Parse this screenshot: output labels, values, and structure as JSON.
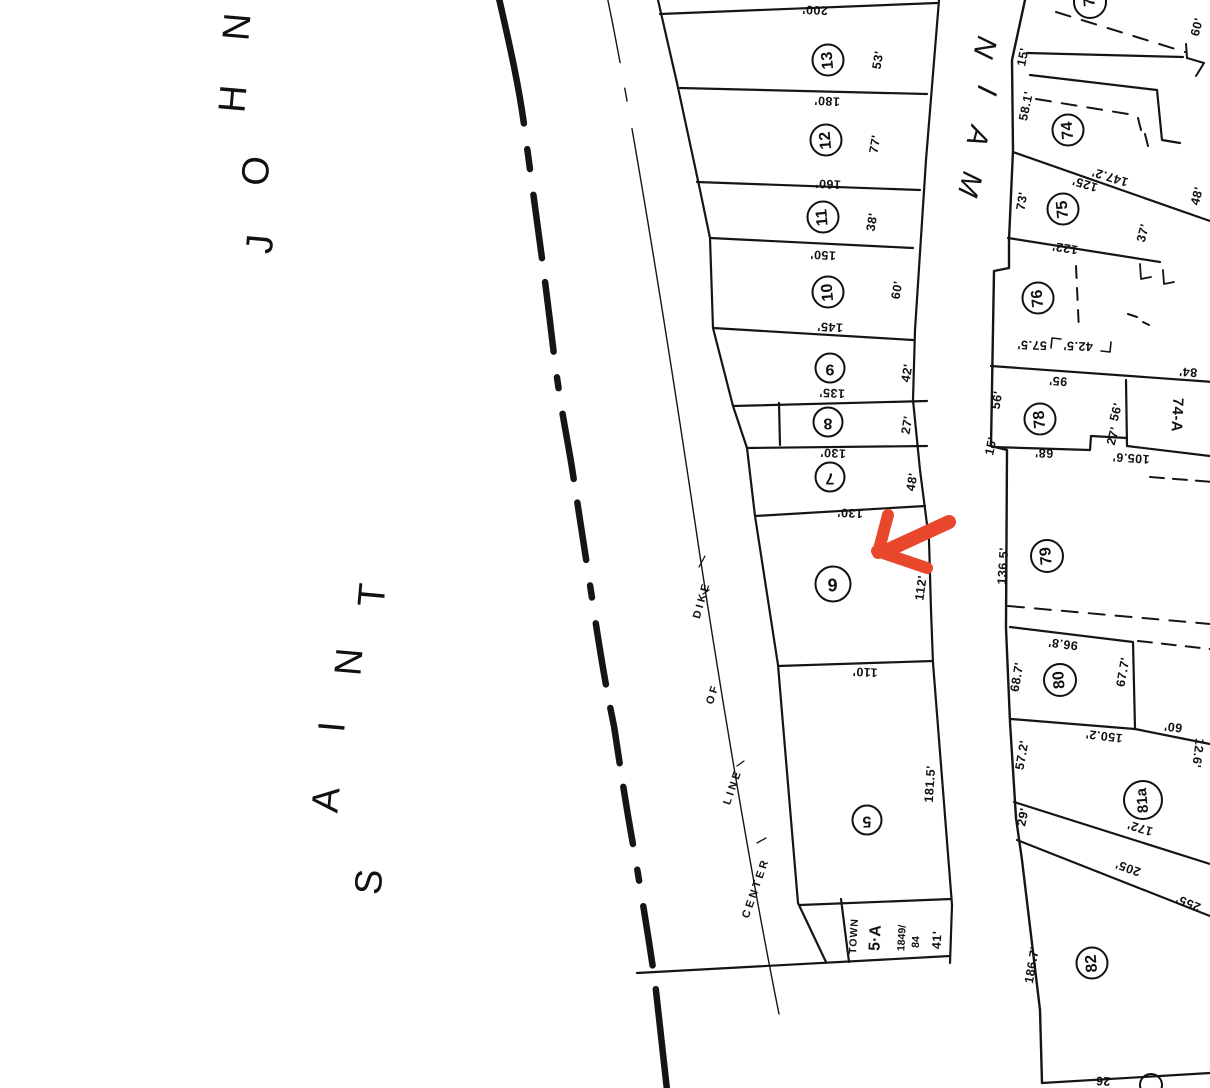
{
  "river": {
    "word1": "SAINT",
    "word2": "JOHN",
    "saint_letters": [
      "S",
      "A",
      "I",
      "N",
      "T"
    ],
    "john_letters": [
      "J",
      "O",
      "H",
      "N"
    ]
  },
  "street": {
    "name": "MAIN",
    "letters": [
      "M",
      "A",
      "I",
      "N"
    ]
  },
  "dike_note": {
    "w1": "CENTER",
    "w2": "LINE",
    "w3": "OF",
    "w4": "DIKE"
  },
  "west": {
    "lots": [
      {
        "num": "13",
        "dim": "200'",
        "front": "53'"
      },
      {
        "num": "12",
        "dim": "180'",
        "front": "77'"
      },
      {
        "num": "11",
        "dim": "160'",
        "front": "38'"
      },
      {
        "num": "10",
        "dim": "150'",
        "front": "60'"
      },
      {
        "num": "9",
        "dim": "145'",
        "front": "42'"
      },
      {
        "num": "8",
        "dim": "135'",
        "front": "27'"
      },
      {
        "num": "7",
        "dim": "130'",
        "front": "48'"
      },
      {
        "num": "6",
        "dim": "130'",
        "front": "112'"
      },
      {
        "num": "5",
        "dim": "110'",
        "front": "181.5'"
      }
    ],
    "town": {
      "label": "TOWN",
      "num": "5·A",
      "deed1": "1849/",
      "deed2": "84",
      "front": "41'"
    }
  },
  "east": {
    "partial_top_num": "7",
    "l74": {
      "num": "74",
      "w1": "15'",
      "w2": "58.1'",
      "ne": "60'",
      "s1": "147.2'",
      "e": "48'"
    },
    "l75": {
      "num": "75",
      "w": "73'",
      "n": "125'",
      "s": "122'",
      "e": "37'"
    },
    "l76": {
      "num": "76",
      "s1": "57.5'",
      "s2": "42.5'"
    },
    "l78": {
      "num": "78",
      "n": "95'",
      "w": "56'",
      "e": "56'",
      "se": "27'",
      "s": "68'",
      "sw": "15'"
    },
    "l74a": {
      "num": "74-A",
      "n": "84'",
      "s": "105.6'"
    },
    "l79": {
      "num": "79",
      "w": "136.5'"
    },
    "l80": {
      "num": "80",
      "n": "96.8'",
      "w": "68.7'",
      "e": "67.7'",
      "s": "150.2'",
      "se": "60'",
      "sw": "57.2'"
    },
    "l81a": {
      "num": "81a",
      "w": "29'",
      "e": "12.6'",
      "s": "172'"
    },
    "lane": {
      "d1": "205'",
      "d2": "255'"
    },
    "l82": {
      "num": "82",
      "w": "186.7'",
      "s": "26"
    }
  },
  "annotation": {
    "arrow_color": "#e8472b",
    "points_at_lot": "6"
  }
}
